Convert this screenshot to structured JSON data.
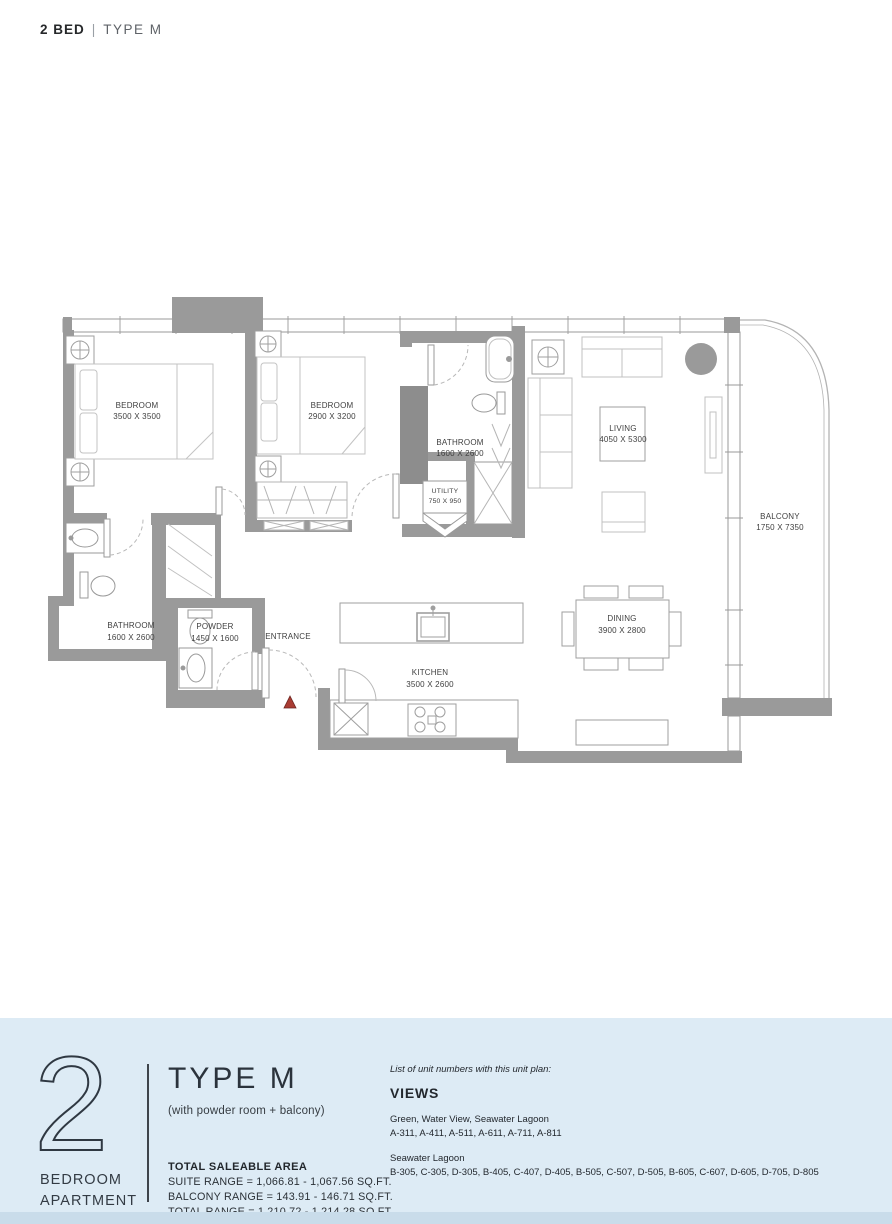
{
  "header": {
    "unit": "2 BED",
    "separator": "|",
    "type": "TYPE M"
  },
  "plan": {
    "rooms": {
      "bedroom1": {
        "name": "BEDROOM",
        "dims": "3500 X 3500"
      },
      "bedroom2": {
        "name": "BEDROOM",
        "dims": "2900 X 3200"
      },
      "bathroom_ensuite": {
        "name": "BATHROOM",
        "dims": "1600 X 2600"
      },
      "utility": {
        "name": "UTILITY",
        "dims": "750 X 950"
      },
      "living": {
        "name": "LIVING",
        "dims": "4050 X 5300"
      },
      "balcony": {
        "name": "BALCONY",
        "dims": "1750 X 7350"
      },
      "bathroom_main": {
        "name": "BATHROOM",
        "dims": "1600 X 2600"
      },
      "powder": {
        "name": "POWDER",
        "dims": "1450 X 1600"
      },
      "entrance": {
        "name": "ENTRANCE"
      },
      "kitchen": {
        "name": "KITCHEN",
        "dims": "3500 X 2600"
      },
      "dining": {
        "name": "DINING",
        "dims": "3900 X 2800"
      }
    },
    "colors": {
      "wall": "#9a9a9a",
      "duct": "#8d8d8d",
      "entry_marker": "#a93c33"
    }
  },
  "footer": {
    "unit_count": "2",
    "unit_label_line1": "BEDROOM",
    "unit_label_line2": "APARTMENT",
    "type_title": "TYPE M",
    "type_subtitle": "(with powder room + balcony)",
    "area": {
      "heading": "TOTAL SALEABLE AREA",
      "suite": "SUITE RANGE = 1,066.81 - 1,067.56 SQ.FT.",
      "balcony": "BALCONY RANGE = 143.91 - 146.71 SQ.FT.",
      "total": "TOTAL RANGE = 1,210.72 - 1,214.28 SQ.FT."
    },
    "views": {
      "intro": "List of unit numbers with this unit plan:",
      "heading": "VIEWS",
      "group1_title": "Green, Water View, Seawater Lagoon",
      "group1_units": "A-311, A-411, A-511, A-611, A-711, A-811",
      "group2_title": "Seawater Lagoon",
      "group2_units": "B-305, C-305, D-305, B-405, C-407, D-405, B-505, C-507, D-505, B-605, C-607, D-605, D-705, D-805"
    },
    "panel_color": "#ddebf5",
    "strip_color": "#c9dcea"
  }
}
